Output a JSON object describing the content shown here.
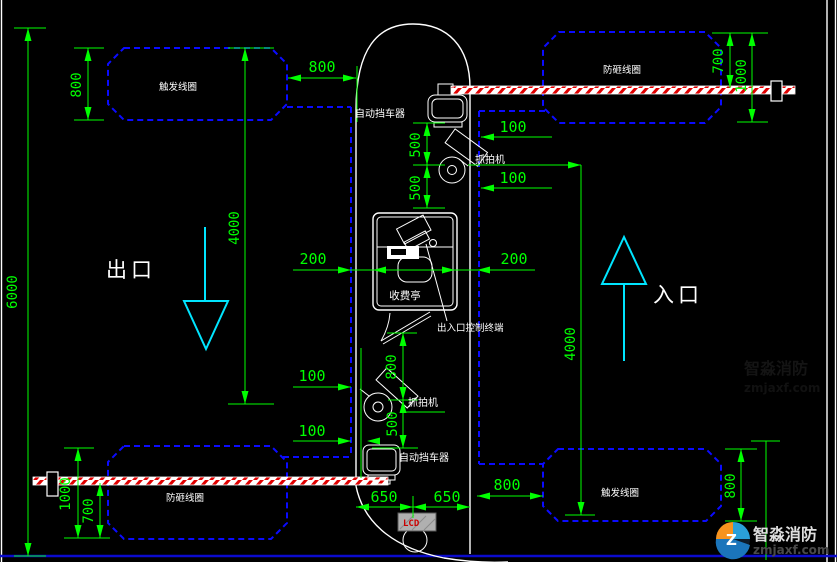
{
  "drawing": {
    "labels": {
      "exit": "出口",
      "entrance": "入口",
      "toll_booth": "收费亭",
      "control_terminal": "出入口控制终端",
      "barrier_top": "自动挡车器",
      "barrier_bottom": "自动挡车器",
      "camera_top": "抓拍机",
      "camera_bottom": "抓拍机",
      "coil_top_left": "触发线圈",
      "coil_top_right": "防砸线圈",
      "coil_bottom_left": "防砸线圈",
      "coil_bottom_right": "触发线圈",
      "lcd_panel": "LCD"
    },
    "dimensions": {
      "d6000": "6000",
      "d800_left": "800",
      "d4000_left": "4000",
      "d800_top": "800",
      "d700_top_right": "700",
      "d1000_top_right": "1000",
      "d100_top_1": "100",
      "d100_top_2": "100",
      "d500_top_1": "500",
      "d500_top_2": "500",
      "d200_left": "200",
      "d200_right": "200",
      "d100_bottom_1": "100",
      "d100_bottom_2": "100",
      "d800_mid": "800",
      "d500_mid": "500",
      "d650_left": "650",
      "d650_right": "650",
      "d800_bottom_h": "800",
      "d800_bottom_v": "800",
      "d4000_right": "4000",
      "d1000_bottom_left": "1000",
      "d700_bottom_left": "700"
    },
    "watermark": {
      "brand": "智淼消防",
      "site": "zmjaxf.com"
    },
    "colors": {
      "dimension": "#00ff00",
      "loop": "#0b0bff",
      "outline": "#ffffff",
      "direction_arrow": "#00e5ff",
      "barrier_stripe": "#ee0000"
    }
  }
}
